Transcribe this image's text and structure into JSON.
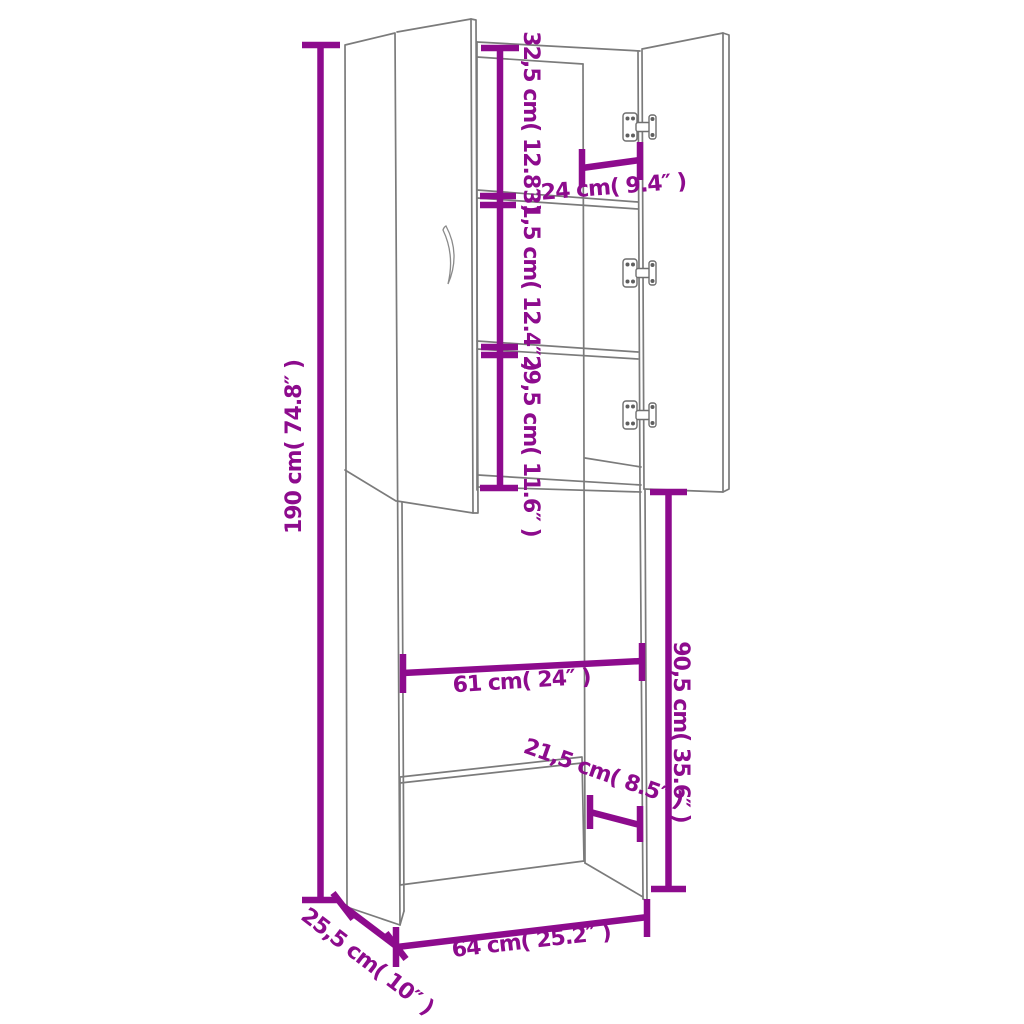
{
  "diagram": {
    "type": "product-dimension-diagram",
    "subject": "tall storage cabinet / washing machine surround, line drawing with open doors",
    "colors": {
      "outline": "#7b7b7b",
      "dimension": "#8d0b8d",
      "background": "#ffffff"
    },
    "labels": {
      "overall_height": "190 cm( 74.8″ )",
      "top_shelf_section": "32,5 cm( 12.8″ )",
      "middle_shelf_section": "31,5 cm( 12.4″ )",
      "lower_shelf_section": "29,5 cm( 11.6″ )",
      "door_opening_depth": "24 cm( 9.4″ )",
      "machine_space_height": "90,5 cm( 35.6″ )",
      "machine_space_width": "61 cm( 24″ )",
      "plinth_offset": "21,5 cm( 8.5″ )",
      "overall_width": "64 cm( 25.2″ )",
      "overall_depth": "25,5 cm( 10″ )"
    }
  }
}
